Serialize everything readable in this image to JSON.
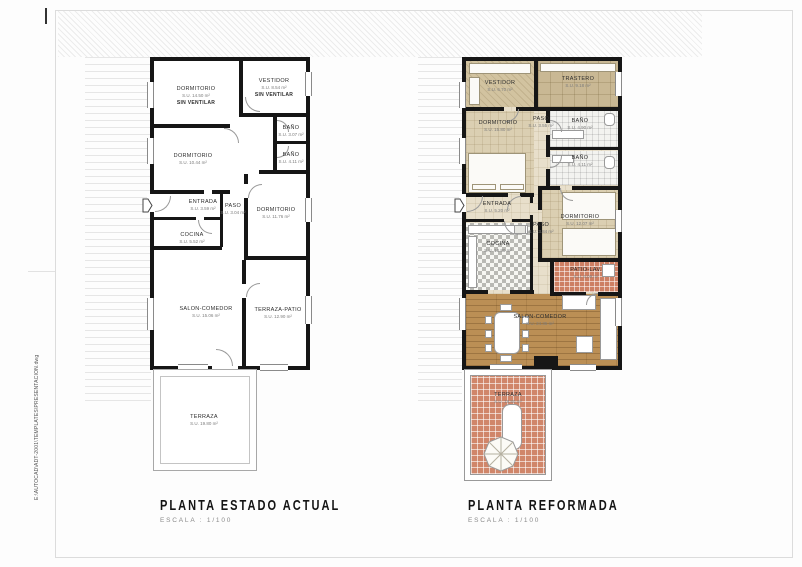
{
  "sheet": {
    "file_path_vertical": "E:\\AUTOCAD\\ADT-2001\\TEMPLATES\\PRESENTACION.dwg"
  },
  "plans": {
    "actual": {
      "title": "PLANTA ESTADO ACTUAL",
      "scale_label": "ESCALA : 1/100",
      "rooms": {
        "dormitorio1": {
          "name": "DORMITORIO",
          "area": "S.U. 14.50 m²",
          "note": "SIN VENTILAR"
        },
        "vestidor": {
          "name": "VESTIDOR",
          "area": "S.U. 8.54 m²",
          "note": "SIN VENTILAR"
        },
        "bano1": {
          "name": "BAÑO",
          "area": "S.U. 3.07 m²"
        },
        "bano2": {
          "name": "BAÑO",
          "area": "S.U. 4.11 m²"
        },
        "dormitorio2": {
          "name": "DORMITORIO",
          "area": "S.U. 10.44 m²"
        },
        "entrada": {
          "name": "ENTRADA",
          "area": "S.U. 3.59 m²"
        },
        "paso": {
          "name": "PASO",
          "area": "S.U. 3.04 m²"
        },
        "dormitorio3": {
          "name": "DORMITORIO",
          "area": "S.U. 11.76 m²"
        },
        "cocina": {
          "name": "COCINA",
          "area": "S.U. 5.52 m²"
        },
        "salon": {
          "name": "SALON-COMEDOR",
          "area": "S.U. 15.06 m²"
        },
        "terraza_patio": {
          "name": "TERRAZA-PATIO",
          "area": "S.U. 12.90 m²"
        },
        "terraza": {
          "name": "TERRAZA",
          "area": "S.U. 19.80 m²"
        }
      }
    },
    "reformada": {
      "title": "PLANTA REFORMADA",
      "scale_label": "ESCALA : 1/100",
      "rooms": {
        "vestidor": {
          "name": "VESTIDOR",
          "area": "S.U. 6.70 m²"
        },
        "trastero": {
          "name": "TRASTERO",
          "area": "S.U. 9.18 m²"
        },
        "dormitorio1": {
          "name": "DORMITORIO",
          "area": "S.U. 15.80 m²"
        },
        "paso1": {
          "name": "PASO",
          "area": "S.U. 3.55 m²"
        },
        "bano1": {
          "name": "BAÑO",
          "area": "S.U. 4.90 m²"
        },
        "bano2": {
          "name": "BAÑO",
          "area": "S.U. 4.11 m²"
        },
        "entrada": {
          "name": "ENTRADA",
          "area": "S.U. 5.20 m²"
        },
        "paso2": {
          "name": "PASO",
          "area": "S.U. 3.84 m²"
        },
        "dormitorio2": {
          "name": "DORMITORIO",
          "area": "S.U. 12.07 m²"
        },
        "cocina": {
          "name": "COCINA",
          "area": "S.U. 10.80 m²"
        },
        "patio_lav": {
          "name": "PATIO-LAV.",
          "area": "S.U. 6.09 m²"
        },
        "salon": {
          "name": "SALON-COMEDOR",
          "area": "S.U. 24.35 m²"
        },
        "terraza": {
          "name": "TERRAZA",
          "area": "S.U. 19.80 m²"
        }
      }
    }
  },
  "colors": {
    "wall": "#161616",
    "wood_floor": "#bb8f55",
    "terracotta_tile": "#cd7f63",
    "beige_floor": "#dbcfb2",
    "bath_tile": "#f3f3f0"
  }
}
